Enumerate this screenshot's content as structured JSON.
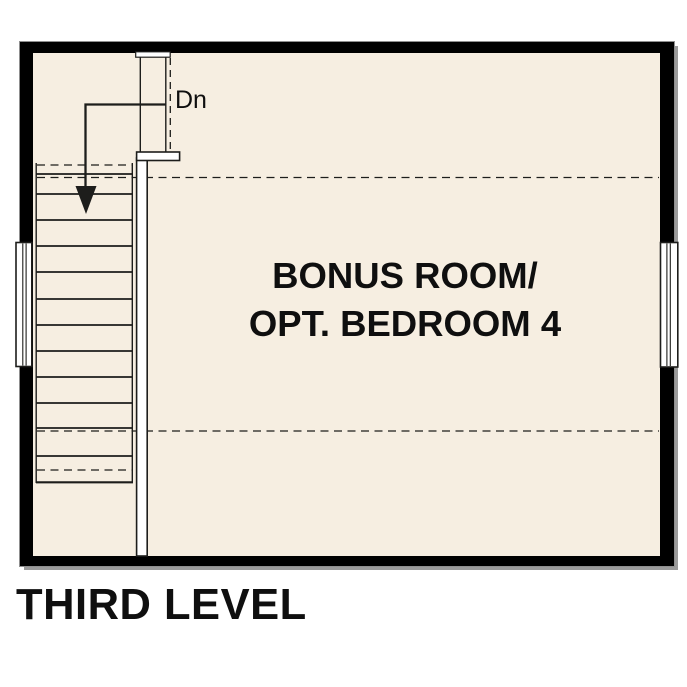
{
  "title": "THIRD LEVEL",
  "plan": {
    "room_label_line1": "BONUS ROOM/",
    "room_label_line2": "OPT. BEDROOM 4",
    "stairs": {
      "direction_label": "Dn",
      "tread_count": 11
    },
    "windows": [
      {
        "side": "left"
      },
      {
        "side": "right"
      }
    ],
    "dashed_ceiling_break_lines": 2
  },
  "colors": {
    "floor": "#f6eee1",
    "wall": "#000000",
    "wall-outline": "#8f8f8f",
    "shadow": "#9b9b9b",
    "line": "#1d1d1b",
    "text": "#0f0f0f",
    "window-fill": "#ffffff"
  }
}
